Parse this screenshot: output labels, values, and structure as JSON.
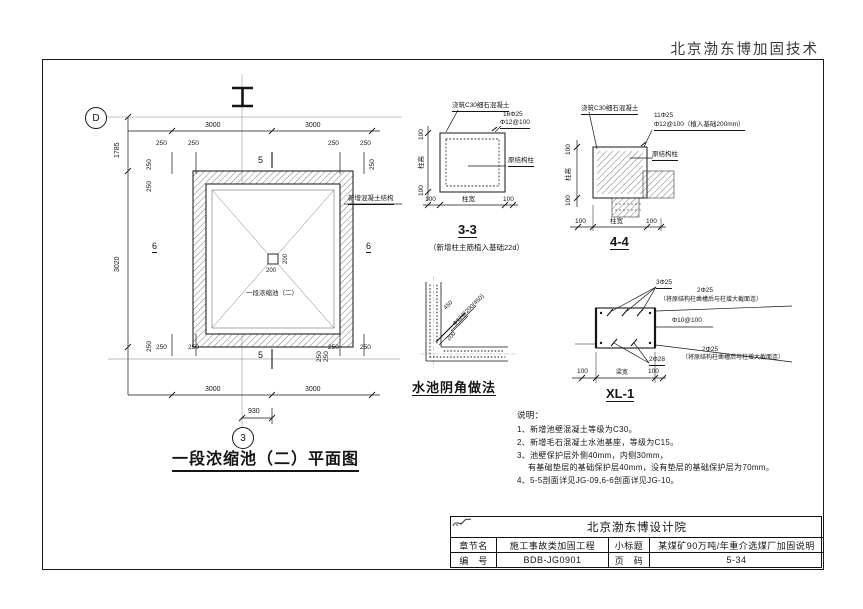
{
  "header": {
    "company_top_right": "北京渤东博加固技术"
  },
  "plan": {
    "title": "一段浓缩池（二）平面图",
    "pool_label": "一段浓缩池（二）",
    "grid_d": "D",
    "grid_3": "3",
    "section_5": "5",
    "section_6": "6",
    "leader_note": "新增混凝土结构",
    "dim_3000": "3000",
    "dim_1785": "1785",
    "dim_3020": "3020",
    "dim_930": "930",
    "dim_250": "250",
    "dim_200": "200"
  },
  "detail_3_3": {
    "title": "3-3",
    "subtitle": "（新增柱主筋植入基础22d）",
    "note_concrete": "浇筑C30细石混凝土",
    "rebar_1": "16Φ25",
    "rebar_2": "Φ12@100",
    "column_label": "原结构柱",
    "dim_100": "100",
    "dim_width": "柱宽",
    "dim_height": "柱高"
  },
  "detail_4_4": {
    "title": "4-4",
    "note_concrete": "浇筑C30细石混凝土",
    "rebar_1": "11Φ25",
    "rebar_2": "Φ12@100（植入基础200mm）",
    "column_label": "原结构柱",
    "dim_100": "100",
    "dim_width": "柱宽",
    "dim_height": "柱高"
  },
  "corner_detail": {
    "title": "水池阴角做法",
    "rebar_label": "Φ12@200(450)",
    "dim_450": "450",
    "dim_200": "200"
  },
  "xl1": {
    "title": "XL-1",
    "top_rebar": "3Φ25",
    "right_top_rebar": "2Φ25",
    "right_top_note": "（将原结构柱凿槽后与柱增大截面连）",
    "stirrup": "Φ10@100",
    "bottom_rebar": "2Φ28",
    "right_bottom_rebar": "2Φ25",
    "right_bottom_note": "（将原结构柱凿槽后与柱增大截面连）",
    "dim_100": "100",
    "dim_width": "梁宽"
  },
  "notes": {
    "heading": "说明：",
    "items": [
      "1、新增池壁混凝土等级为C30。",
      "2、新增毛石混凝土水池基座，等级为C15。",
      "3、池壁保护层外侧40mm，内侧30mm，",
      "有基础垫层的基础保护层40mm，没有垫层的基础保护层为70mm。",
      "4、5-5剖面详见JG-09,6-6剖面详见JG-10。"
    ]
  },
  "title_block": {
    "company": "北京渤东博设计院",
    "chapter_label": "章节名",
    "chapter_value": "施工事故类加固工程",
    "subtitle_label": "小标题",
    "subtitle_value": "某煤矿90万吨/年重介选煤厂加固说明",
    "number_label": "编　号",
    "number_value": "BDB-JG0901",
    "page_label": "页　码",
    "page_value": "5-34"
  },
  "colors": {
    "line": "#1a1a1a",
    "paper": "#ffffff"
  }
}
